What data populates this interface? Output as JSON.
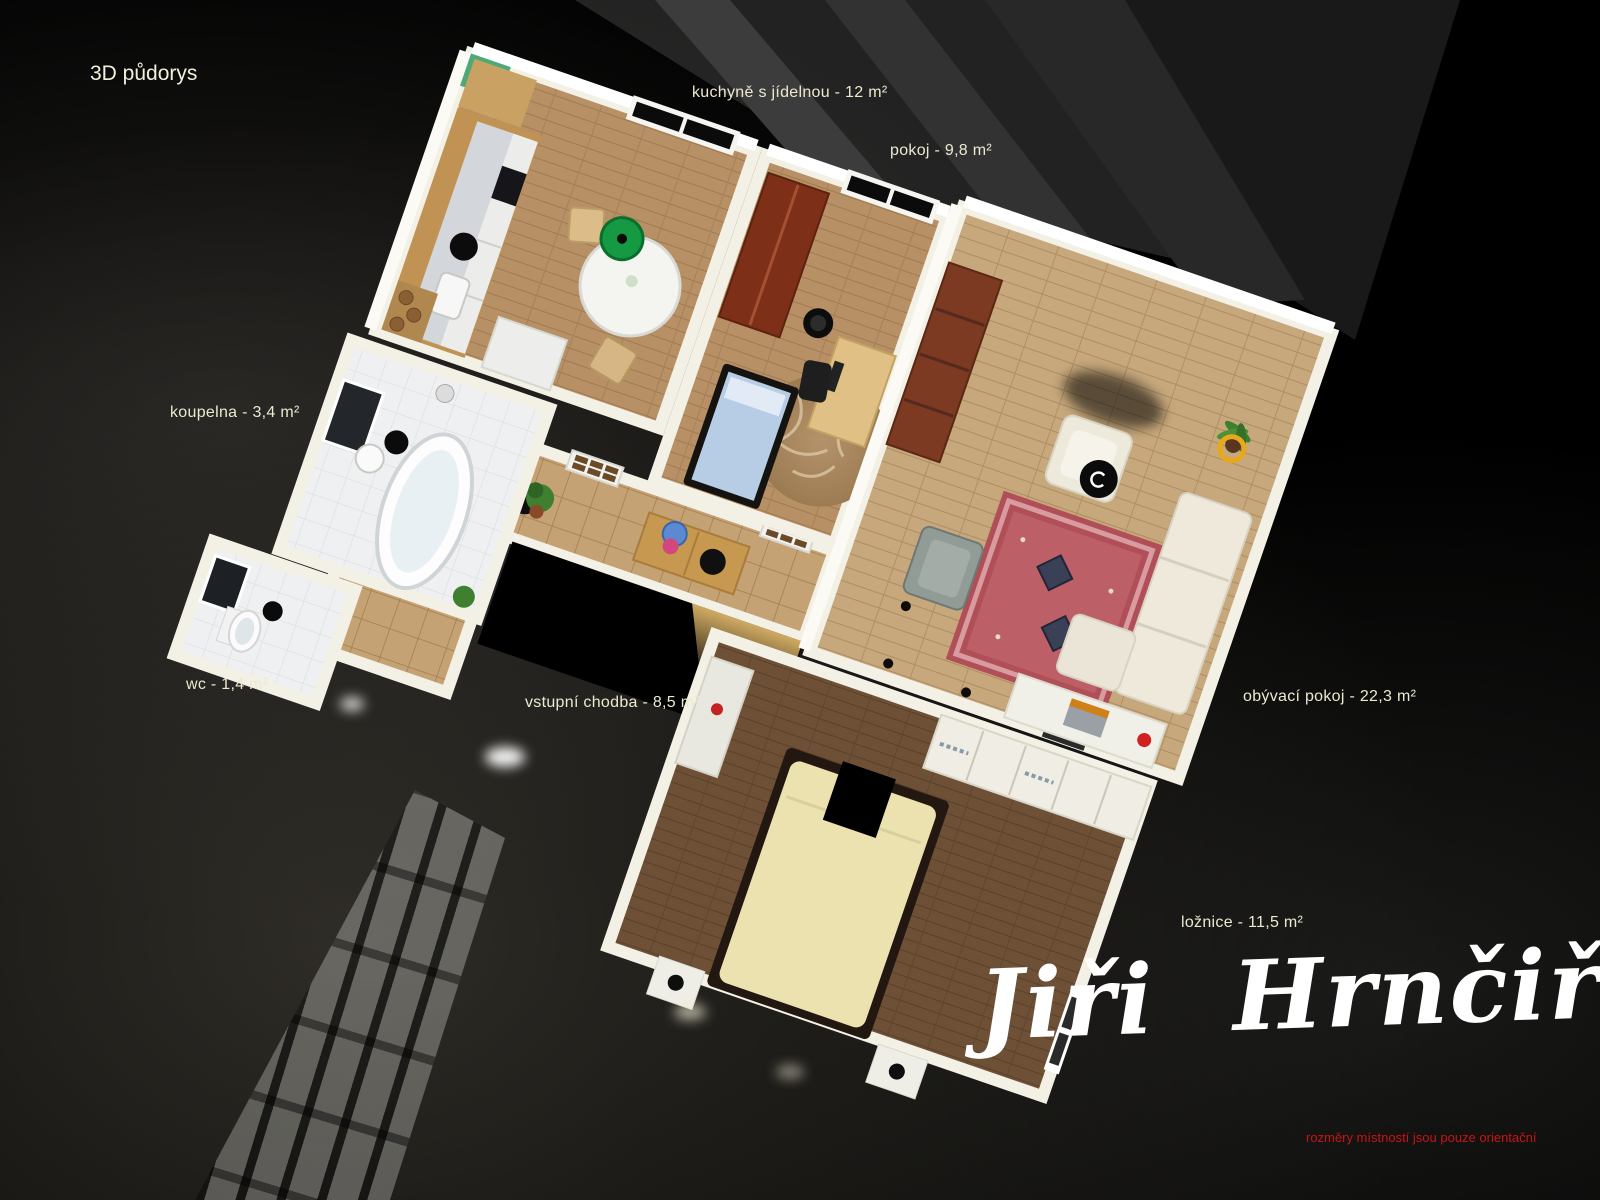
{
  "title": "3D půdorys",
  "rooms": [
    {
      "name": "kuchyně s jídelnou",
      "area": "12 m²",
      "label": "kuchyně s jídelnou - 12 m²"
    },
    {
      "name": "pokoj",
      "area": "9,8 m²",
      "label": "pokoj - 9,8 m²"
    },
    {
      "name": "koupelna",
      "area": "3,4 m²",
      "label": "koupelna - 3,4 m²"
    },
    {
      "name": "wc",
      "area": "1,4 m²",
      "label": "wc - 1,4 m²"
    },
    {
      "name": "vstupní chodba",
      "area": "8,5 m²",
      "label": "vstupní chodba - 8,5 m²"
    },
    {
      "name": "obývací pokoj",
      "area": "22,3 m²",
      "label": "obývací pokoj - 22,3 m²"
    },
    {
      "name": "ložnice",
      "area": "11,5 m²",
      "label": "ložnice - 11,5 m²"
    }
  ],
  "signature": "Jiři Hrnčiř",
  "disclaimer": "rozměry místností jsou pouze orientační",
  "colors": {
    "label-color": "#ece9d0",
    "title-color": "#f3f0da",
    "signature-color": "#ffffff",
    "disclaimer-color": "#c81414",
    "background-color": "#000000"
  }
}
